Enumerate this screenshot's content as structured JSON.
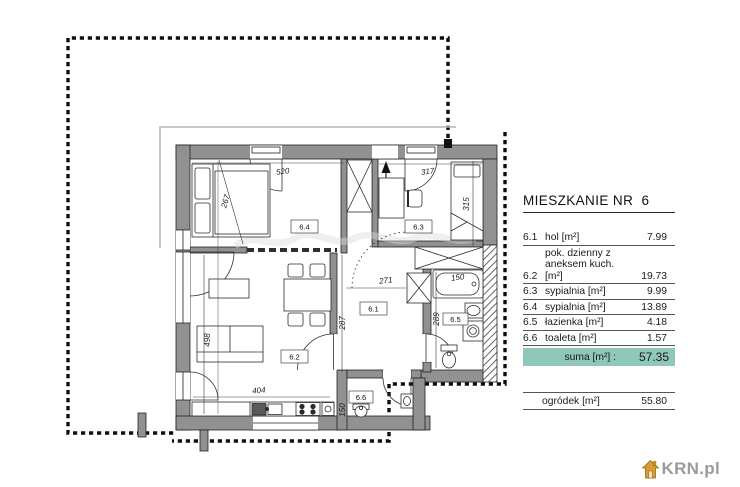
{
  "summary_panel": {
    "title": "MIESZKANIE NR  6",
    "unit_rows": [
      {
        "no": "6.1",
        "label": "hol [m²]",
        "value": "7.99"
      },
      {
        "no": "6.2",
        "label_line1": "pok. dzienny z",
        "label_line2": "aneksem kuch. [m²]",
        "value": "19.73"
      },
      {
        "no": "6.3",
        "label": "sypialnia [m²]",
        "value": "9.99"
      },
      {
        "no": "6.4",
        "label": "sypialnia [m²]",
        "value": "13.89"
      },
      {
        "no": "6.5",
        "label": "łazienka [m²]",
        "value": "4.18"
      },
      {
        "no": "6.6",
        "label": "toaleta [m²]",
        "value": "1.57"
      }
    ],
    "total_label": "suma [m²] :",
    "total_value": "57.35",
    "garden_label": "ogródek [m²]",
    "garden_value": "55.80"
  },
  "plan": {
    "room_labels": {
      "hol": "6.1",
      "living": "6.2",
      "bedroom_small": "6.3",
      "bedroom_large": "6.4",
      "bathroom": "6.5",
      "toilet": "6.6"
    },
    "dimensions": {
      "bedroom_large_width": "520",
      "bedroom_large_depth": "267",
      "bedroom_small_width": "317",
      "bedroom_small_depth": "315",
      "living_left_wall": "498",
      "kitchen_wall": "404",
      "living_hall_wall": "287",
      "hall_width": "271",
      "bathroom_depth": "289",
      "bathtub_width": "150",
      "toilet_width": "150"
    }
  },
  "branding": {
    "logo_text": "KRN.pl"
  },
  "colors": {
    "wall_fill": "#919191",
    "suma_row_bg": "#8fc7ba",
    "dash_color": "#0d0d0d",
    "logo_text_color": "#9a9a9a",
    "logo_house_color": "#d79b2e"
  }
}
